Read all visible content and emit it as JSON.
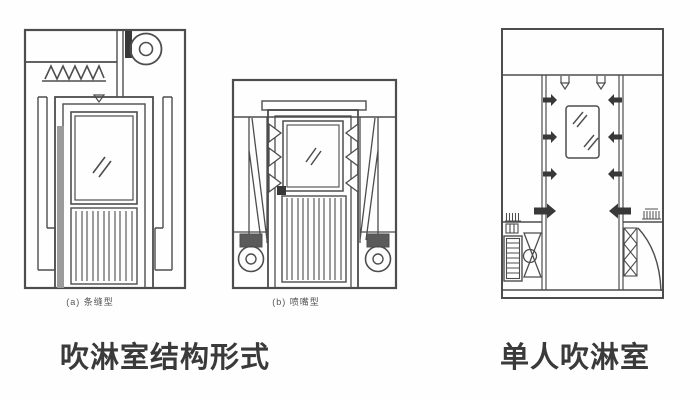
{
  "page": {
    "background": "#fefefe",
    "description_visible_text_only": true
  },
  "colors": {
    "line": "#4d4d4d",
    "dark_fill": "#383838",
    "gray_strip": "#9b9b9b",
    "caption_text": "#3a3a3a",
    "subcaption_text": "#555555"
  },
  "left_figure": {
    "subfigure_a_label": "(a) 条缝型",
    "subfigure_b_label": "(b) 喷嘴型",
    "caption": "吹淋室结构形式"
  },
  "right_figure": {
    "caption": "单人吹淋室"
  }
}
